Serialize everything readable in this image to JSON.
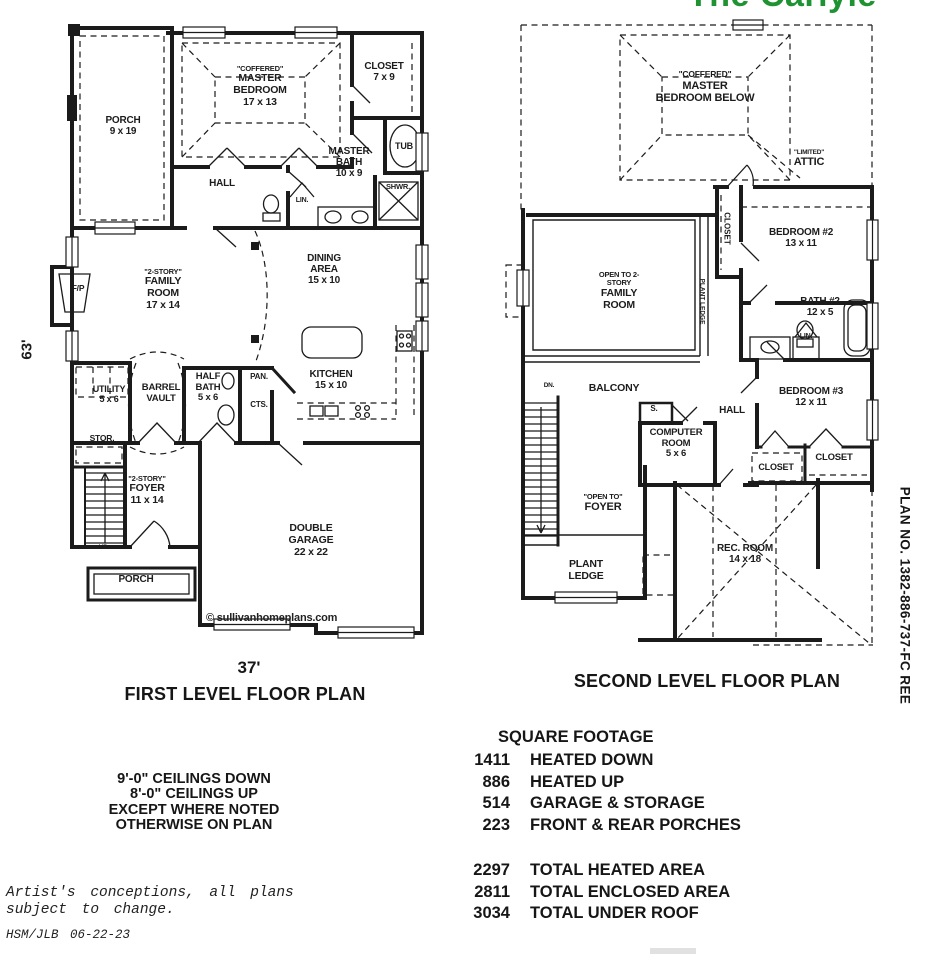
{
  "title": {
    "text": "The Carlyle"
  },
  "colors": {
    "title_green": "#1f9331",
    "ink": "#1b1b1b"
  },
  "plan_number": "PLAN NO.  1382-886-737-FC REE",
  "dimensions": {
    "left_height": "63'",
    "bottom_width": "37'"
  },
  "first_floor": {
    "caption": "FIRST LEVEL FLOOR PLAN",
    "watermark": "© sullivanhomeplans.com",
    "stairs_label": "UP",
    "rooms": {
      "porch_top": {
        "name": "PORCH",
        "dims": "9 x 19"
      },
      "master_bedroom": {
        "pre": "\"COFFERED\"",
        "name": "MASTER BEDROOM",
        "dims": "17 x 13"
      },
      "closet": {
        "name": "CLOSET",
        "dims": "7 x 9"
      },
      "tub": {
        "name": "TUB"
      },
      "master_bath": {
        "name": "MASTER BATH",
        "dims": "10 x 9"
      },
      "shower": {
        "name": "SHWR."
      },
      "linen": {
        "name": "LIN."
      },
      "hall": {
        "name": "HALL"
      },
      "dining": {
        "name": "DINING AREA",
        "dims": "15 x 10"
      },
      "family_room": {
        "pre": "\"2-STORY\"",
        "name": "FAMILY ROOM",
        "dims": "17 x 14"
      },
      "fireplace": {
        "name": "F/P"
      },
      "utility": {
        "name": "UTILITY",
        "dims": "5 x 6"
      },
      "barrel_vault": {
        "name": "BARREL VAULT"
      },
      "half_bath": {
        "name": "HALF BATH",
        "dims": "5 x 6"
      },
      "pantry": {
        "name": "PAN."
      },
      "coats": {
        "name": "CTS."
      },
      "kitchen": {
        "name": "KITCHEN",
        "dims": "15 x 10"
      },
      "storage": {
        "name": "STOR."
      },
      "foyer": {
        "pre": "\"2-STORY\"",
        "name": "FOYER",
        "dims": "11 x 14"
      },
      "porch_bottom": {
        "name": "PORCH"
      },
      "garage": {
        "name": "DOUBLE GARAGE",
        "dims": "22 x 22"
      }
    }
  },
  "second_floor": {
    "caption": "SECOND LEVEL FLOOR PLAN",
    "stairs_label": "DN.",
    "rooms": {
      "master_below": {
        "pre": "\"COFFERED\"",
        "name": "MASTER BEDROOM BELOW"
      },
      "attic": {
        "pre": "\"LIMITED\"",
        "name": "ATTIC"
      },
      "closet_bed2": {
        "name": "CLOSET"
      },
      "bedroom2": {
        "name": "BEDROOM #2",
        "dims": "13 x 11"
      },
      "open_family": {
        "pre": "OPEN TO 2-STORY",
        "name": "FAMILY ROOM"
      },
      "plant_ledge_rail": {
        "name": "PLANT LEDGE"
      },
      "bath2": {
        "name": "BATH #2",
        "dims": "12 x 5"
      },
      "linen2": {
        "name": "LIN."
      },
      "bedroom3": {
        "name": "BEDROOM #3",
        "dims": "12 x 11"
      },
      "closet_hall": {
        "name": "CLOSET"
      },
      "closet_bed3": {
        "name": "CLOSET"
      },
      "balcony": {
        "name": "BALCONY"
      },
      "shelf": {
        "name": "S."
      },
      "computer_room": {
        "name": "COMPUTER ROOM",
        "dims": "5 x 6"
      },
      "hall": {
        "name": "HALL"
      },
      "open_foyer": {
        "pre": "\"OPEN TO\"",
        "name": "FOYER"
      },
      "plant_ledge": {
        "name": "PLANT LEDGE"
      },
      "rec_room": {
        "name": "REC. ROOM",
        "dims": "14 x 18"
      }
    }
  },
  "square_footage": {
    "title": "SQUARE FOOTAGE",
    "rows": [
      {
        "value": "1411",
        "label": "HEATED DOWN"
      },
      {
        "value": "886",
        "label": "HEATED UP"
      },
      {
        "value": "514",
        "label": "GARAGE & STORAGE"
      },
      {
        "value": "223",
        "label": "FRONT & REAR PORCHES"
      }
    ],
    "totals": [
      {
        "value": "2297",
        "label": "TOTAL HEATED AREA"
      },
      {
        "value": "2811",
        "label": "TOTAL ENCLOSED AREA"
      },
      {
        "value": "3034",
        "label": "TOTAL UNDER ROOF"
      }
    ]
  },
  "notes": {
    "ceilings": [
      "9'-0\" CEILINGS DOWN",
      "8'-0\" CEILINGS UP",
      "EXCEPT WHERE NOTED",
      "OTHERWISE ON PLAN"
    ],
    "disclaimer": [
      "Artist's conceptions, all plans",
      "subject to change."
    ],
    "revision": "HSM/JLB  06-22-23"
  }
}
